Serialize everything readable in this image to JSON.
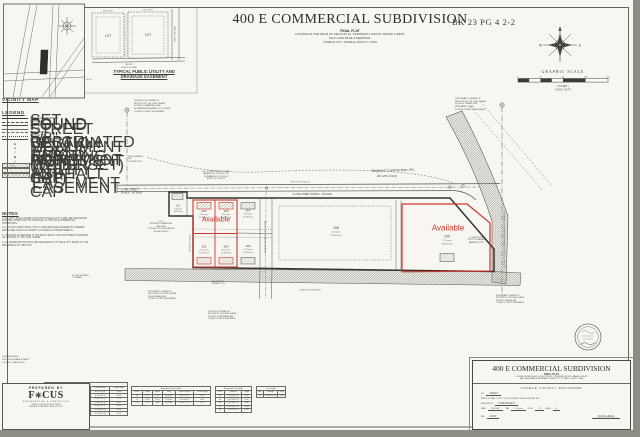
{
  "scan": {
    "book_page": "BK 23 PG 4 2-2"
  },
  "header": {
    "title": "400 E COMMERCIAL SUBDIVISION",
    "subtitle": "FINAL PLAT",
    "loc1": "LOCATED IN THE SW1/4 OF SECTION 10, TOWNSHIP 3 SOUTH, RANGE 4 WEST,",
    "loc2": "SALT LAKE BASE & MERIDIAN,",
    "loc3": "TOOELE CITY, TOOELE COUNTY,  UTAH"
  },
  "vicinity": {
    "label": "VICINITY MAP"
  },
  "detail": {
    "lot_a": "LOT",
    "lot_b": "LOT",
    "dim_a": "10.0' P.U.E.",
    "dim_b": "10.0' P.U.E.",
    "front_1": "FRONT",
    "front_2": "RIGHT OF WAY",
    "side": "RIGHT OF WAY",
    "caption1": "TYPICAL PUBLIC UTILITY AND",
    "caption2": "DRAINAGE EASEMENT",
    "nts": "N.T.S."
  },
  "compass": {
    "w": "W",
    "e": "E"
  },
  "scalebar": {
    "title": "GRAPHIC SCALE",
    "t0": "0",
    "t1": "25",
    "t2": "50",
    "t3": "100",
    "t4": "150",
    "units": "( IN FEET )",
    "ratio": "1 INCH = 50 FT."
  },
  "legend": {
    "title": "LEGEND",
    "lines": [
      "SUBDIVISION BOUNDARY",
      "CENTERLINE",
      "RIGHT OF WAY LINE",
      "LOT LINE",
      "EASEMENT LINE",
      "SECTION LINE",
      "ADJACENT PROPERTY LINE"
    ],
    "symbols": [
      "FOUND SECTION MONUMENT",
      "STREET MONUMENT (TO BE SET)",
      "FOUND REBAR AND CAP",
      "SET 5/8\" REBAR AND CAP",
      "CALCULATED POINT (NOT SET)"
    ],
    "areas": [
      "EXISTING ASPHALT",
      "PUBLIC UTILITY EASEMENT",
      "WATER EASEMENT"
    ]
  },
  "notes": {
    "title": "NOTES:",
    "p1": "1. ALL LOTS SHALL COMPLY WITH THE TOOELE CITY LAND USE ORDINANCE AND THE CONDITIONS OF APPROVAL OF THE 400 E COMMERCIAL SUBDIVISION.",
    "p2": "2. A 10 FOOT WIDE PUBLIC UTILITY AND DRAINAGE EASEMENT IS HEREBY DEDICATED ALONG ALL FRONT LOT LINES AS SHOWN HEREON.",
    "p3": "3. THE BASIS OF BEARING IS THE EAST LINE OF THE SOUTHWEST QUARTER OF SECTION 10, T3S, R4W, SLB&M.",
    "p4": "4. ALL WATER RIGHTS SHALL BE DEDICATED TO TOOELE CITY PRIOR TO THE RECORDING OF THIS PLAT."
  },
  "plat": {
    "street_vine_left1": "E VINE STREET",
    "street_vine_left2": "(PUBLIC - 66' ROW)",
    "street_vine_right": "E VINE STREET  (PUBLIC - 66' ROW)",
    "street_mid": "250 EAST  (PUBLIC - 41.5' ROW)",
    "top_dim": "S 89°54'19\" E   660.00'",
    "west_dim": "N 0°05'41\" E   103.03'",
    "south_dim": "S 89°54'19\" W   659.88'",
    "basis": "N 0°09'47\" E  2643.43' (MEASURED)  BASIS OF BEARING",
    "available": "Available",
    "script_owner": "Bayland Construction, Inc.",
    "script_parcel": "(86-1299-0-0010)",
    "vacated": "EX. 20' WIDE RIGHT OF WAY\nVACATED BY TOOELE CITY\nORDINANCE NO. 2021-08\nENTRY NO. 549872",
    "mon_center": "CENTER 1/4 CORNER OF\nSECTION 10, T3S, R4W, SLB&M\nFOUND 3\" DIAMETER FLAT\nALUMINUM MONUMENT (0.5' DOWN)\nTOOELE COUNTY MONUMENT",
    "mon_ne": "NORTHEAST CORNER OF\nSECTION 10, T3S, R4W, SLB&M\nFOUND 3\" BRASS CAP\nMONUMENT (1998)\nTOOELE COUNTY MONUMENT",
    "mon_sw": "SOUTHWEST CORNER OF\nSECTION 10, T3S, R4W, SLB&M\nFOUND BRASS CAP\nTOOELE COUNTY MONUMENT",
    "mon_s4": "SOUTH 1/4 CORNER OF\nSECTION 10, T3S, R4W, SLB&M\nFOUND 3\" FLAT BRASS CAP\nTOOELE COUNTY MONUMENT",
    "mon_se": "SOUTHEAST CORNER OF\nSECTION 10, T3S, R4W, SLB&M\nFOUND 3\" BRASS CAP\nTOOELE COUNTY MONUMENT",
    "note_small_1": "FOUND REBAR & CAP\nLS 356842 (TYP.)",
    "note_small_2": "EX. FIRE HYDRANT\nTO REMAIN",
    "edge_note": "EX. EDGE OF\nASPHALT (TYP.)",
    "pue_note": "10' WIDE PUBLIC\nUTILITY & DRAINAGE\nEASEMENT (TYP.)",
    "lot1_note": "LOT 1\nEXISTING COMMERCIAL\nBUILDING\nTOOELE CITY CORPORATION\n(86-1042-0-0001)",
    "lots": [
      {
        "num": "101",
        "acres": "0.23 acres",
        "sqft": "10,019 sq ft"
      },
      {
        "num": "103",
        "acres": "0.73 acres",
        "sqft": "31,799 sq ft"
      },
      {
        "num": "105",
        "acres": "0.73 acres",
        "sqft": "31,799 sq ft"
      },
      {
        "num": "107",
        "acres": "0.73 acres",
        "sqft": "31,799 sq ft"
      },
      {
        "num": "102",
        "acres": "0.72 acres",
        "sqft": "31,363 sq ft"
      },
      {
        "num": "104",
        "acres": "0.72 acres",
        "sqft": "31,363 sq ft"
      },
      {
        "num": "106",
        "acres": "0.72 acres",
        "sqft": "31,363 sq ft"
      },
      {
        "num": "108",
        "acres": "3.02 acres",
        "sqft": "131,551 sq ft"
      },
      {
        "num": "109",
        "acres": "2.73 acres",
        "sqft": "118,919 sq ft"
      }
    ]
  },
  "tables": {
    "curve": {
      "title": "Curve Table",
      "headers": [
        "Curve #",
        "Length",
        "Radius",
        "Delta",
        "Chord Direction",
        "Chord Length"
      ],
      "rows": [
        [
          "C1",
          "39.27",
          "25.00",
          "90°00'00\"",
          "N 44°57'55\" E",
          "35.36"
        ],
        [
          "C2",
          "39.27",
          "25.00",
          "90°00'00\"",
          "S 45°02'05\" E",
          "35.36"
        ],
        [
          "C3",
          "23.56",
          "15.00",
          "90°00'00\"",
          "N 44°57'55\" W",
          "21.21"
        ],
        [
          "C4",
          "23.56",
          "15.00",
          "90°00'00\"",
          "S 45°02'05\" W",
          "21.21"
        ],
        [
          "C5",
          "54.98",
          "35.00",
          "90°00'00\"",
          "N 44°57'55\" E",
          "49.50"
        ],
        [
          "C6",
          "31.42",
          "20.00",
          "90°00'00\"",
          "S 45°02'05\" E",
          "28.28"
        ],
        [
          "C7",
          "15.71",
          "10.00",
          "90°00'00\"",
          "N 44°57'55\" W",
          "14.14"
        ]
      ]
    },
    "ecurve": {
      "title": "Easement Curve Table",
      "headers": [
        "Curve #",
        "Length",
        "Radius",
        "Delta",
        "Chord Direction",
        "Chord Length"
      ],
      "rows": [
        [
          "C8",
          "12.57",
          "8.00",
          "90°00'00\"",
          "N 44°57'55\" E",
          "11.31"
        ],
        [
          "C9",
          "18.85",
          "12.00",
          "90°00'00\"",
          "S 45°02'05\" E",
          "16.97"
        ],
        [
          "C10",
          "12.57",
          "8.00",
          "90°00'00\"",
          "S 44°57'55\" W",
          "11.31"
        ]
      ]
    },
    "eline": {
      "title": "Easement Line Table",
      "headers": [
        "Line #",
        "Direction",
        "Length"
      ],
      "rows": [
        [
          "E1",
          "N 0°05'41\" E",
          "10.00"
        ],
        [
          "E2",
          "N 89°54'19\" W",
          "10.00"
        ],
        [
          "E3",
          "S 0°05'41\" W",
          "10.00"
        ],
        [
          "E4",
          "N 89°54'19\" W",
          "15.00"
        ],
        [
          "E5",
          "N 0°05'41\" E",
          "15.00"
        ]
      ]
    },
    "line": {
      "title": "Line Table",
      "headers": [
        "Line #",
        "Direction",
        "Length"
      ],
      "rows": [
        [
          "L1",
          "N 45°02'05\" W",
          "14.14"
        ]
      ]
    }
  },
  "prepared": {
    "contact": "DTM BUILDERS\n230 SOUTH MAIN STREET\nTOOELE, UTAH 84074",
    "label": "PREPARED BY",
    "logo_f": "F",
    "logo_rest": "CUS",
    "logo_sub": "ENGINEERING & SURVEYING",
    "address": "6949 SOUTH HIGH TECH DRIVE\nMIDVALE, UTAH 84047   (801) 352-0075"
  },
  "recorder": {
    "title": "400 E COMMERCIAL SUBDIVISION",
    "subtitle": "FINAL PLAT",
    "loc1": "LOCATED IN THE SW1/4 OF SECTION 10, TOWNSHIP 3 SOUTH, RANGE 4 WEST,",
    "loc2": "SALT LAKE BASE & MERIDIAN,  TOOELE CITY, TOOELE COUNTY, UTAH",
    "office": "TOOELE COUNTY RECORDER",
    "no_label": "NO.",
    "no_value": "546927",
    "line1": "STATE OF UTAH, COUNTY OF TOOELE, RECORDED & FILED AT THE",
    "line2": "REQUEST OF",
    "request_value": "DTM Builders",
    "date_label": "DATE",
    "date_value": "5/9/2022",
    "time_label": "TIME",
    "time_value": "3:36 pm",
    "book_label": "BOOK",
    "book_value": "23",
    "page_label": "PAGE",
    "page_value": "4",
    "fee_label": "FEE",
    "fee_value": "28.00",
    "sig_value": "Delene Ahlm",
    "sig_title": "TOOELE COUNTY RECORDER"
  }
}
